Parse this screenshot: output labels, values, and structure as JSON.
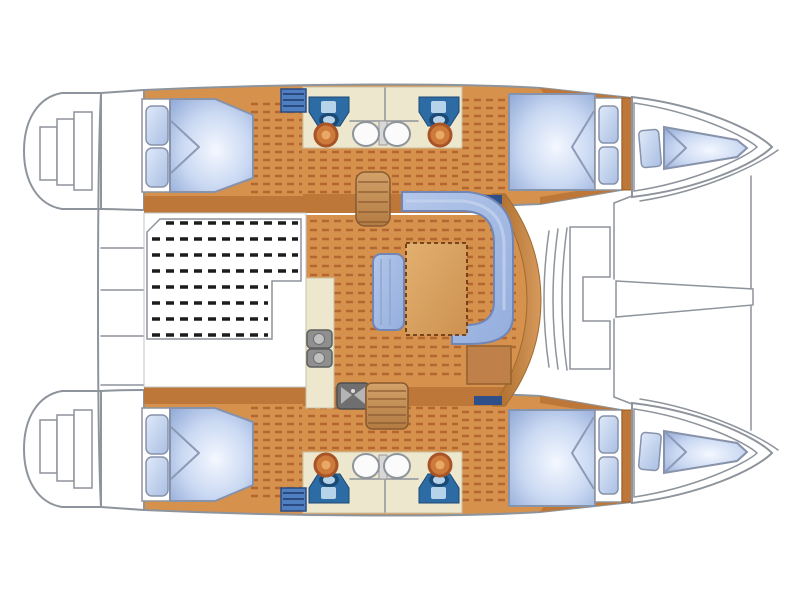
{
  "colors": {
    "bg": "#ffffff",
    "outline": "#8e949c",
    "floor_orange": "#d6914c",
    "hull_band": "#bd7738",
    "plank_dash": "#9c4a1e",
    "slat_dash": "#1c1c1c",
    "cream": "#ede7cd",
    "cream_border": "#c9c2a4",
    "bed_border": "#8792ab",
    "sofa_border": "#7186b5",
    "toilet_blue": "#2c6ba3",
    "toilet_dark": "#1d4a74",
    "toilet_light": "#b7d3ea",
    "sink_ring": "#a85426",
    "sink_fill": "#cd7a3a",
    "basin_white": "#fbfbfb",
    "stairs_line": "#8a5a30",
    "table_border": "#6b3a14",
    "sideboard": "#c08049",
    "stove_gray": "#8f8f8f",
    "stove_light": "#c0c0c0",
    "sink_unit": "#6f6f6f",
    "hatch_blue": "#4f7fc0",
    "hatch_line": "#2a4a80",
    "navy_bar": "#2f4f8a",
    "cockpit_border": "#c2c7cd"
  }
}
